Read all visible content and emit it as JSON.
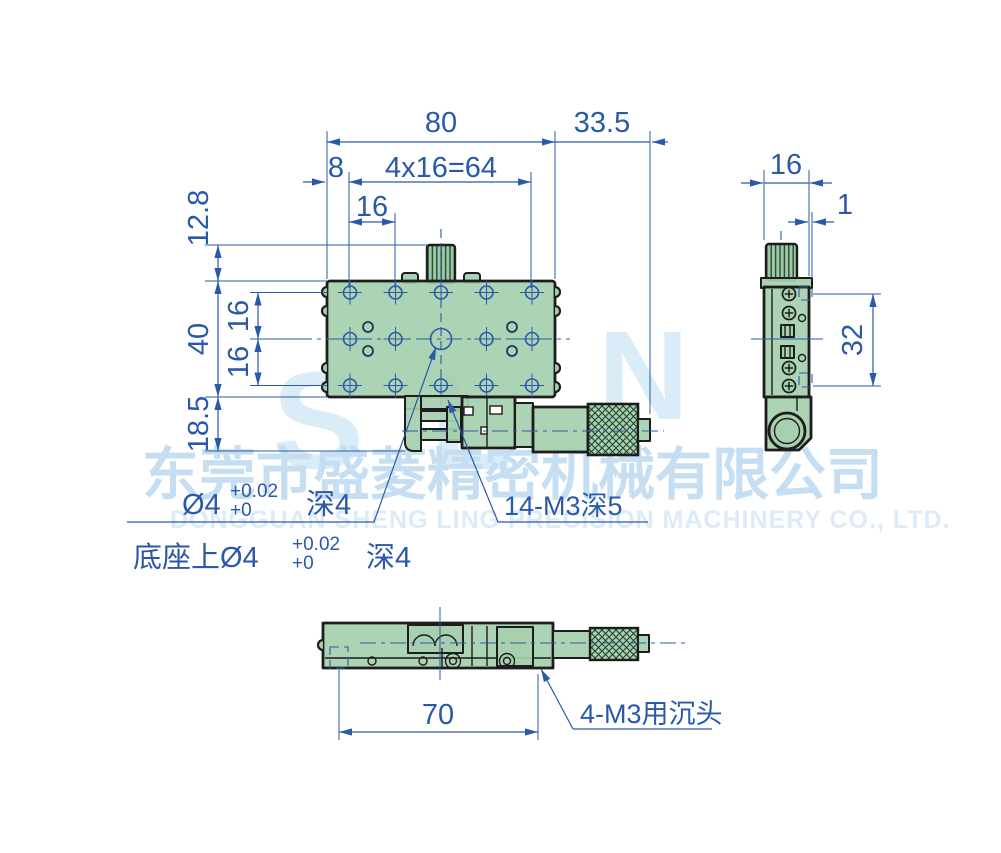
{
  "drawing": {
    "dims_top_view": {
      "overall_width": "80",
      "micrometer_offset": "33.5",
      "edge_margin": "8",
      "hole_pattern": "4x16=64",
      "hole_pitch": "16",
      "knob_offset": "12.8",
      "overall_depth": "40",
      "row_pitch_upper": "16",
      "row_pitch_lower": "16",
      "base_height": "18.5"
    },
    "dims_side_view": {
      "thickness": "16",
      "plate_offset": "1",
      "screw_span": "32"
    },
    "dims_bottom_view": {
      "mount_length": "70"
    },
    "annotations": {
      "center_hole": {
        "prefix": "Ø4",
        "tol_upper": "+0.02",
        "tol_lower": "+0",
        "suffix": "深4"
      },
      "base_hole": {
        "prefix": "底座上Ø4",
        "tol_upper": "+0.02",
        "tol_lower": "+0",
        "suffix": "深4"
      },
      "thread_holes": "14-M3深5",
      "countersunk_holes": "4-M3用沉头"
    }
  },
  "watermark": {
    "logo_s": "S",
    "logo_l": "L",
    "logo_n": "N",
    "company_cn": "东莞市盛菱精密机械有限公司",
    "company_en": "DONGGUAN SHENG LING PRECISION MACHINERY CO., LTD."
  },
  "colors": {
    "dimension_blue": "#2b59a9",
    "part_green": "#a5cfae",
    "outline_dark": "#1d1d1d",
    "watermark_logo": "#d9ecf8",
    "watermark_cn": "#c5def2",
    "watermark_en": "#dcebf7"
  }
}
